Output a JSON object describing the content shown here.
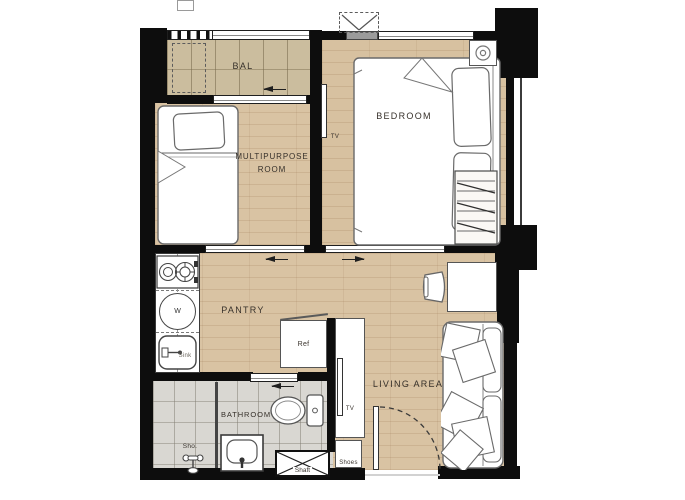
{
  "plan": {
    "rooms": {
      "balcony": "BAL",
      "bedroom": "BEDROOM",
      "multipurpose_line1": "MULTIPURPOSE",
      "multipurpose_line2": "ROOM",
      "pantry": "PANTRY",
      "bathroom": "BATHROOM",
      "living": "LIVING AREA"
    },
    "fixtures": {
      "tv_bedroom": "TV",
      "tv_living": "TV",
      "ref": "Ref",
      "sink": "Sink",
      "washer": "W",
      "shower": "Sho.",
      "shaft": "Shaft",
      "shoes": "Shoes"
    },
    "colors": {
      "wall": "#0d0d0d",
      "wood_floor": "#d9c3a3",
      "balcony_floor": "#cbbd9e",
      "bathroom_floor": "#d9d7d2",
      "label_text": "#36302a"
    }
  }
}
